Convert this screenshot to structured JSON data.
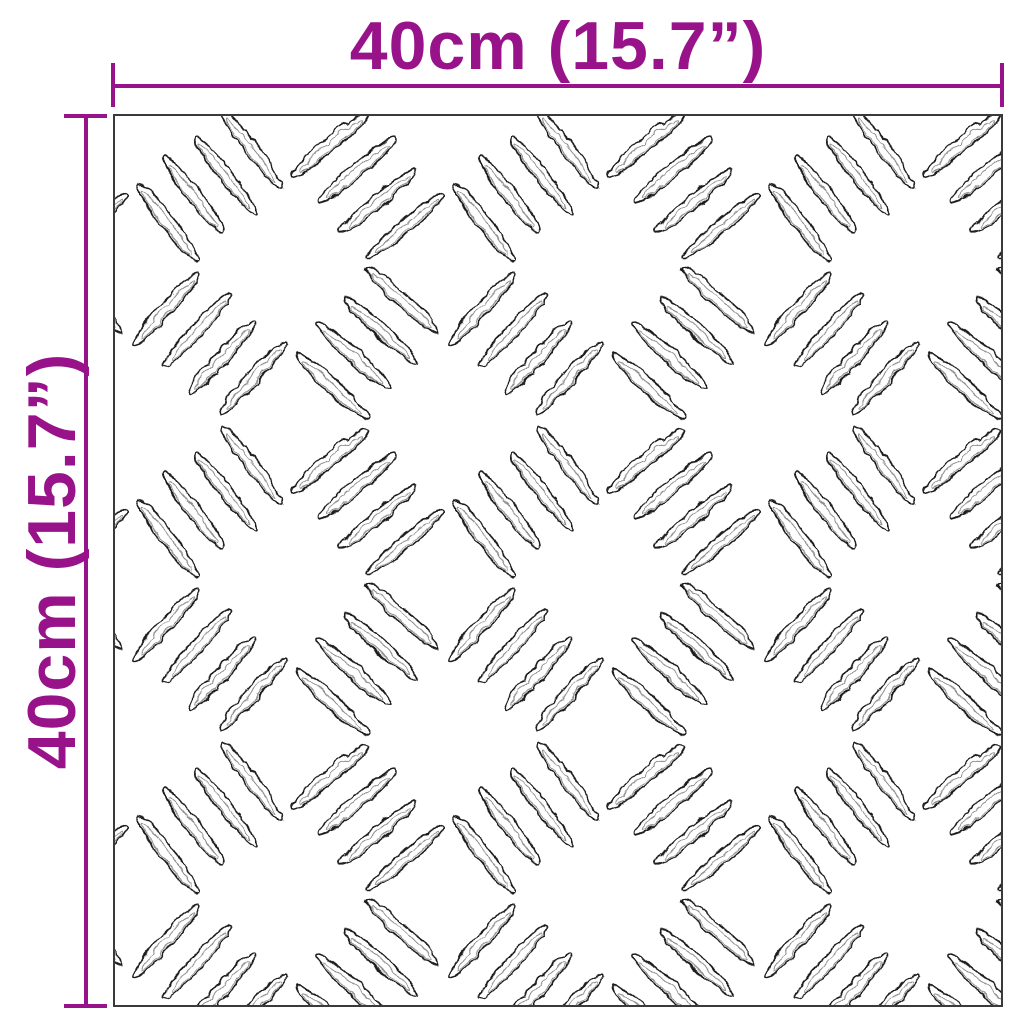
{
  "diagram": {
    "width_dimension": {
      "label": "40cm (15.7”)"
    },
    "height_dimension": {
      "label": "40cm (15.7”)"
    },
    "colors": {
      "background": "#ffffff",
      "dimension_accent": "#98138A",
      "plate_border": "#3a3a3a",
      "tread_stroke": "#1d1d1d",
      "tread_inner_stroke": "#8d8d8d"
    }
  }
}
